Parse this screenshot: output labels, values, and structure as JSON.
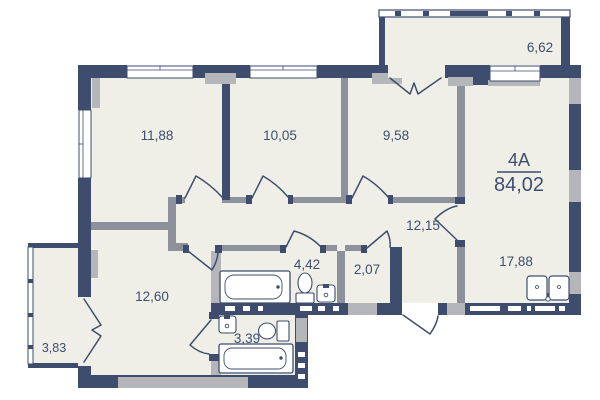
{
  "plan": {
    "unit_label": "4A",
    "total_area": "84,02",
    "rooms": {
      "bedroom_1": "11,88",
      "bedroom_2": "10,05",
      "bedroom_3": "9,58",
      "balcony_top": "6,62",
      "hallway": "12,15",
      "bathroom": "4,42",
      "storage": "2,07",
      "kitchen": "17,88",
      "living": "12,60",
      "wc": "3,39",
      "balcony_left": "3,83"
    },
    "colors": {
      "wall": "#3e4d6e",
      "partition": "#8d919b",
      "accent_gray": "#b4b6b9",
      "floor": "#f0efe7",
      "text": "#3e4e6f",
      "background": "#ffffff"
    }
  }
}
